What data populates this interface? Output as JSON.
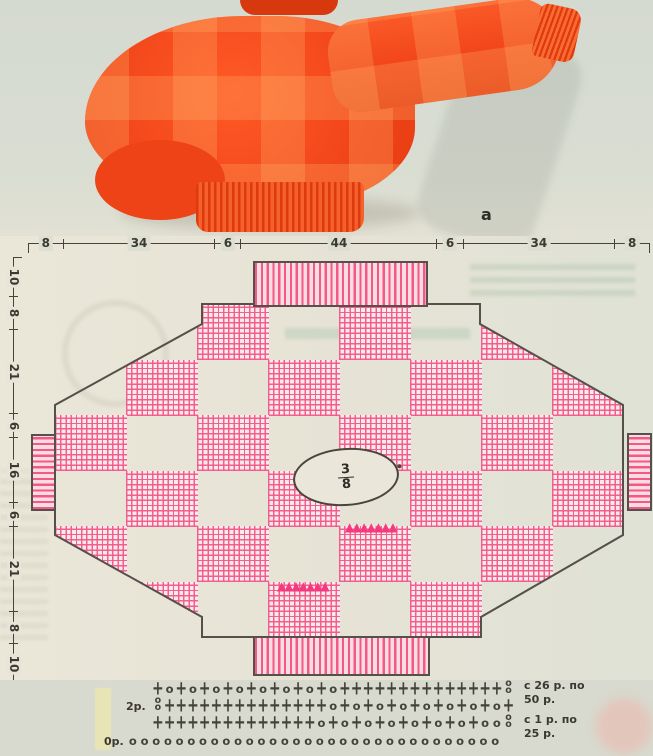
{
  "photo": {
    "caption": "а",
    "description_name": "orange-checkered-batwing-sweater"
  },
  "colors": {
    "pattern_pink": "#f2598a",
    "pink_fill": "#fce9eb",
    "sweater_orange": "#f1451a",
    "outline_dark": "#55504a",
    "symbol_dark": "#45423a",
    "mark_pink": "#f5397e"
  },
  "dimensions": {
    "top": [
      "8",
      "34",
      "6",
      "44",
      "6",
      "34",
      "8"
    ],
    "left": [
      "10",
      "8",
      "21",
      "6",
      "16",
      "6",
      "21",
      "8",
      "10"
    ]
  },
  "schematic": {
    "neck_fraction": {
      "numerator": "3",
      "denominator": "8"
    },
    "checkerboard": {
      "cols": 8,
      "rows": 6,
      "pink_when": "col+row even"
    },
    "mark_glyphs": "▲▲▲▲▲▲▲",
    "decrease_marks": [
      {
        "x": 345,
        "y": 521
      },
      {
        "x": 277,
        "y": 580
      }
    ]
  },
  "crochet_chart": {
    "rows": [
      {
        "label": "",
        "symbols": "+o+o+o+o+o+o+o+o++++++++++++++8"
      },
      {
        "label": "2р.",
        "symbols": "8++++++++++++++o+o+o+o+o+o+o+o+"
      },
      {
        "label": "",
        "symbols": "++++++++++++++o+o+o+o+o+o+o+oo8"
      },
      {
        "label": "0р.",
        "symbols": "oooooooooooooooooooooooooooooooo"
      }
    ],
    "right_labels": [
      {
        "line1": "с 26 р. по",
        "line2": "50 р."
      },
      {
        "line1": "с 1 р. по",
        "line2": "25 р."
      }
    ]
  }
}
